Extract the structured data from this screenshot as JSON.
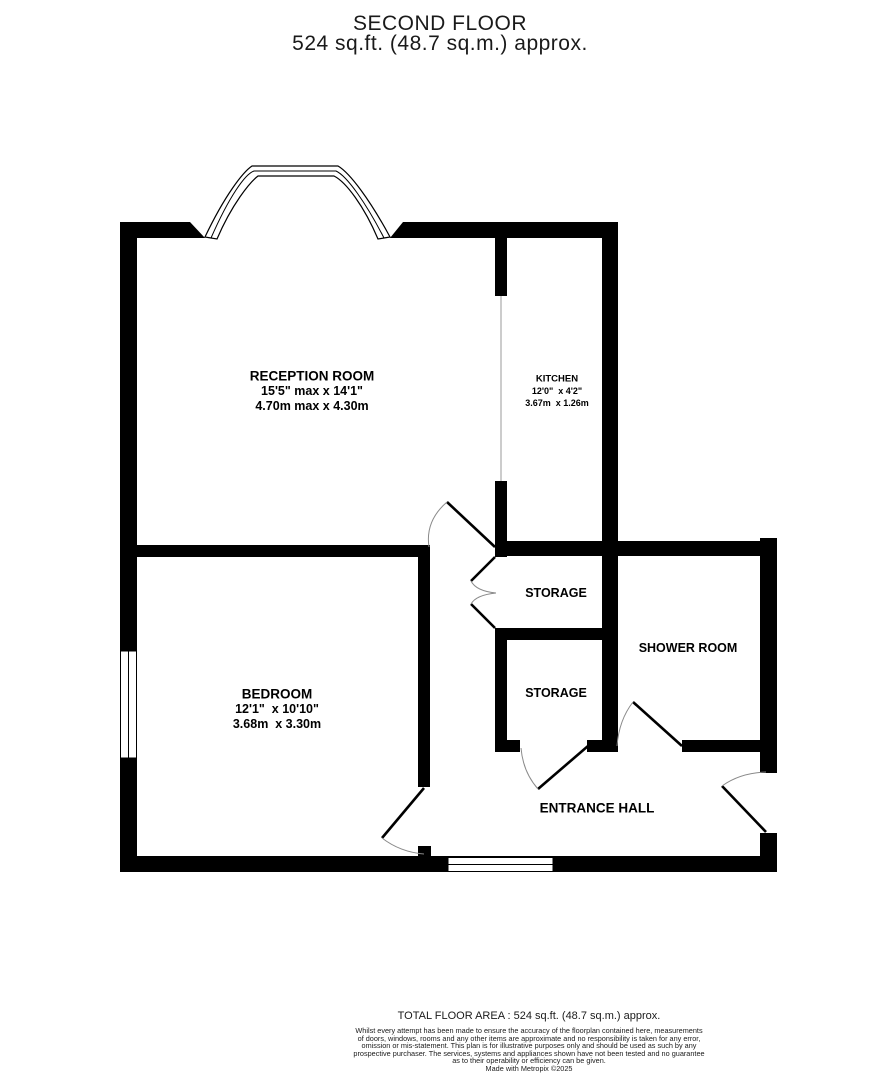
{
  "header": {
    "title": "SECOND FLOOR",
    "subtitle": "524 sq.ft. (48.7 sq.m.) approx."
  },
  "rooms": {
    "reception": {
      "name": "RECEPTION ROOM",
      "dims_imperial": "15'5\" max x 14'1\"",
      "dims_metric": "4.70m max x 4.30m"
    },
    "kitchen": {
      "name": "KITCHEN",
      "dims_imperial": "12'0\"  x 4'2\"",
      "dims_metric": "3.67m  x 1.26m"
    },
    "bedroom": {
      "name": "BEDROOM",
      "dims_imperial": "12'1\"  x 10'10\"",
      "dims_metric": "3.68m  x 3.30m"
    },
    "storage_upper": {
      "name": "STORAGE"
    },
    "storage_lower": {
      "name": "STORAGE"
    },
    "shower": {
      "name": "SHOWER ROOM"
    },
    "hall": {
      "name": "ENTRANCE HALL"
    }
  },
  "footer": {
    "total_area": "TOTAL FLOOR AREA : 524 sq.ft. (48.7 sq.m.) approx.",
    "disclaimer_lines": [
      "Whilst every attempt has been made to ensure the accuracy of the floorplan contained here, measurements",
      "of doors, windows, rooms and any other items are approximate and no responsibility is taken for any error,",
      "omission or mis-statement. This plan is for illustrative purposes only and should be used as such by any",
      "prospective purchaser. The services, systems and appliances shown have not been tested and no guarantee",
      "as to their operability or efficiency can be given."
    ],
    "credit": "Made with Metropix ©2025"
  },
  "colors": {
    "wall": "#000000",
    "background": "#ffffff",
    "door_arc": "#8a8a8a",
    "opening_line": "#9a9a9a"
  }
}
